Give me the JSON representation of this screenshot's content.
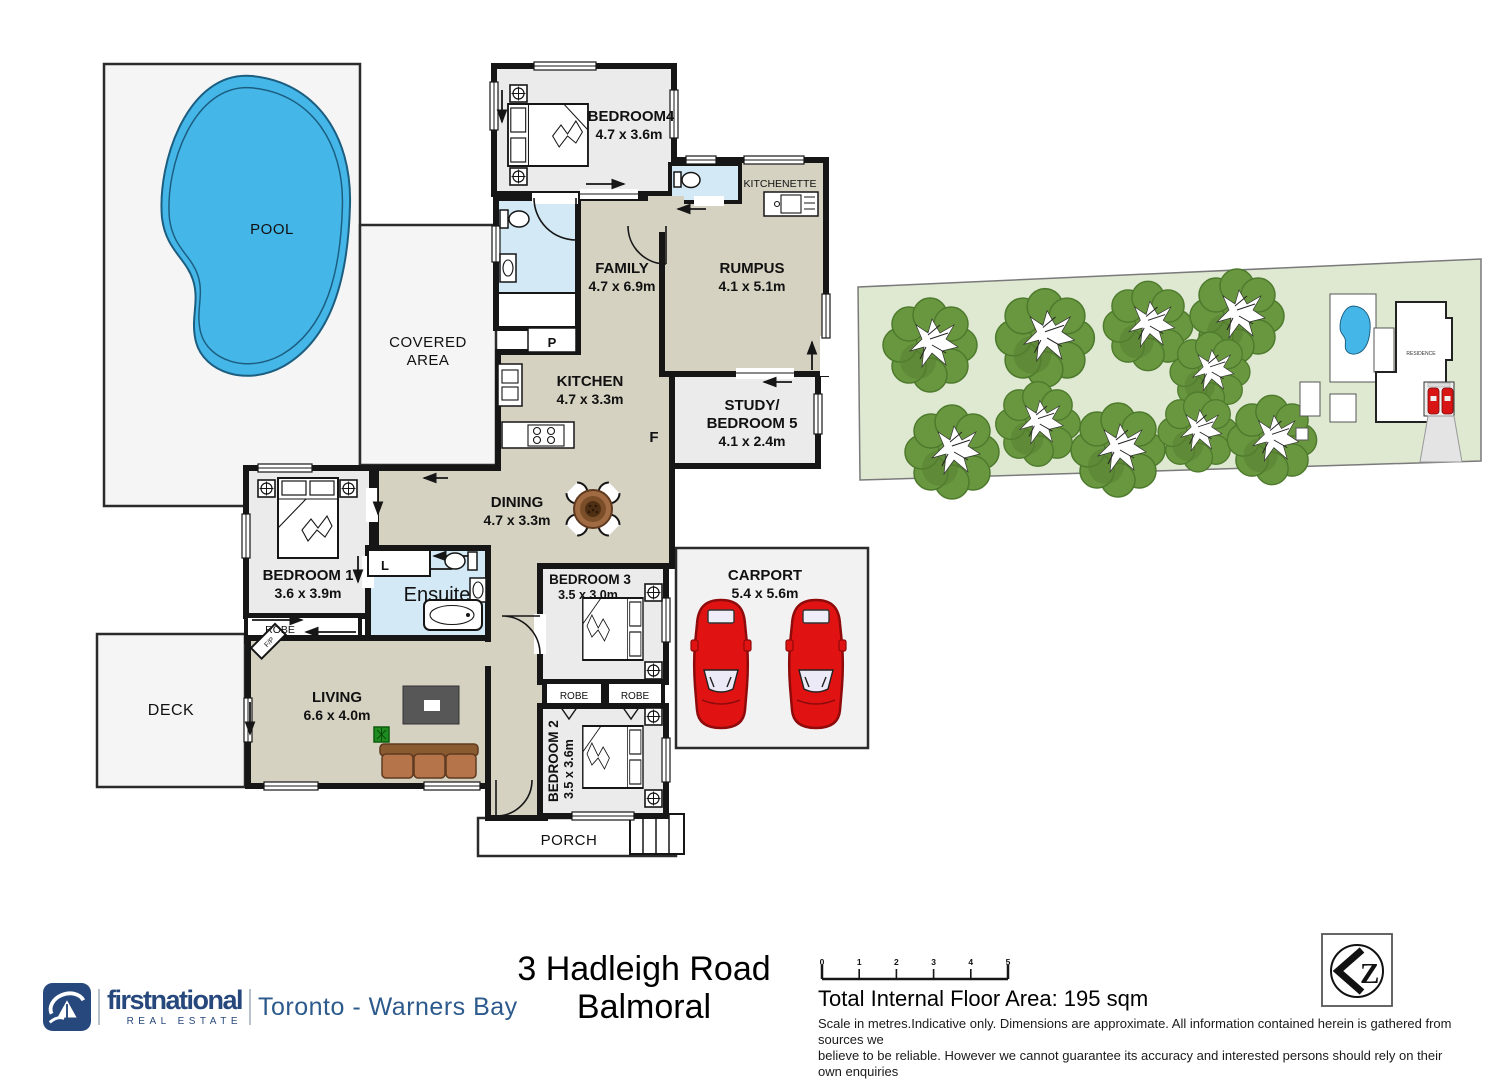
{
  "title": "3 Hadleigh Road Balmoral floor plan",
  "plan": {
    "pool": {
      "label": "POOL"
    },
    "covered_area": {
      "line1": "COVERED",
      "line2": "AREA"
    },
    "deck": {
      "label": "DECK"
    },
    "porch": {
      "label": "PORCH"
    },
    "carport": {
      "name": "CARPORT",
      "dims": "5.4 x 5.6m"
    },
    "bedroom4": {
      "name": "BEDROOM4",
      "dims": "4.7 x 3.6m"
    },
    "kitchenette": {
      "label": "KITCHENETTE"
    },
    "family": {
      "name": "FAMILY",
      "dims": "4.7 x 6.9m"
    },
    "rumpus": {
      "name": "RUMPUS",
      "dims": "4.1 x 5.1m"
    },
    "kitchen": {
      "name": "KITCHEN",
      "dims": "4.7 x 3.3m"
    },
    "pantry_label": "P",
    "fridge_label": "F",
    "study": {
      "line1": "STUDY/",
      "line2": "BEDROOM 5",
      "dims": "4.1 x 2.4m"
    },
    "dining": {
      "name": "DINING",
      "dims": "4.7 x 3.3m"
    },
    "bedroom1": {
      "name": "BEDROOM 1",
      "dims": "3.6 x 3.9m"
    },
    "ensuite": {
      "name": "Ensuite",
      "linen_label": "L"
    },
    "robe_label": "ROBE",
    "living": {
      "name": "LIVING",
      "dims": "6.6 x 4.0m"
    },
    "fireplace_label": "F/P",
    "bedroom3": {
      "name": "BEDROOM 3",
      "dims": "3.5 x 3.0m"
    },
    "bedroom2": {
      "name": "BEDROOM 2",
      "dims": "3.5 x 3.6m"
    }
  },
  "site_plan": {
    "residence_label": "RESIDENCE"
  },
  "footer": {
    "brand": "firstnational",
    "brand_sub": "REAL ESTATE",
    "office": "Toronto - Warners Bay",
    "address_line1": "3 Hadleigh Road",
    "address_line2": "Balmoral",
    "floor_area": "Total Internal Floor Area: 195 sqm",
    "disclaimer_line1": "Scale in metres.Indicative only. Dimensions are approximate. All information contained herein is gathered from sources we",
    "disclaimer_line2": "believe to be reliable. However we cannot guarantee its accuracy and interested persons should rely on their own enquiries",
    "scale_ticks": [
      "0",
      "1",
      "2",
      "3",
      "4",
      "5"
    ],
    "compass_label": "Z"
  },
  "colors": {
    "wall": "#161616",
    "floor": "#d5d2c2",
    "bedroom_floor": "#ebebeb",
    "wet_area": "#d3e9f5",
    "outdoor": "#f5f5f5",
    "pool_water": "#45b6e8",
    "lot_green": "#dfe9d2",
    "tree_green": "#69973f",
    "car_red": "#e11212",
    "brand_blue": "#27487c"
  }
}
